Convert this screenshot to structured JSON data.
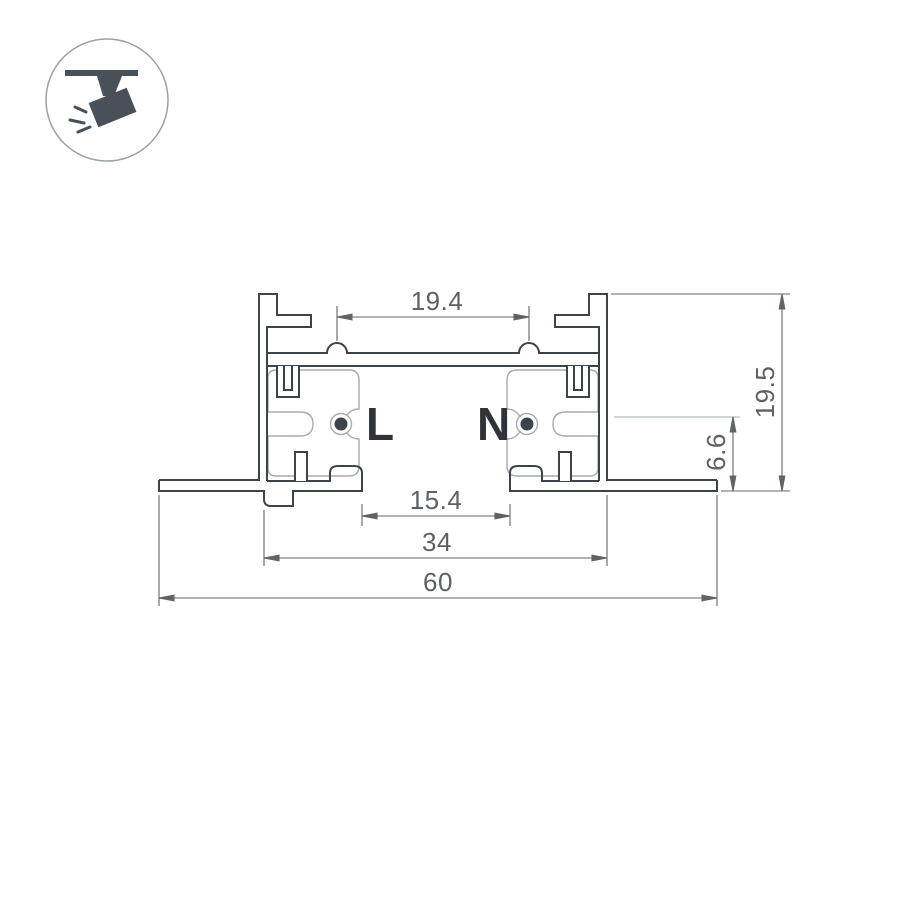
{
  "icon": {
    "name": "track-spotlight-icon",
    "description": "ceiling track with tilted spotlight"
  },
  "labels": {
    "live": "L",
    "neutral": "N"
  },
  "dimensions": {
    "top_opening": "19.4",
    "overall_height": "19.5",
    "conductor_depth": "6.6",
    "bottom_opening": "15.4",
    "body_width": "34",
    "overall_width": "60"
  },
  "colors": {
    "profile_line": "#3e434a",
    "dimension_line": "#606468",
    "insulator_line": "#a6abb0",
    "label_text": "#2f343a",
    "icon_fill": "#4a5057",
    "icon_circle": "#9ba0a5"
  }
}
